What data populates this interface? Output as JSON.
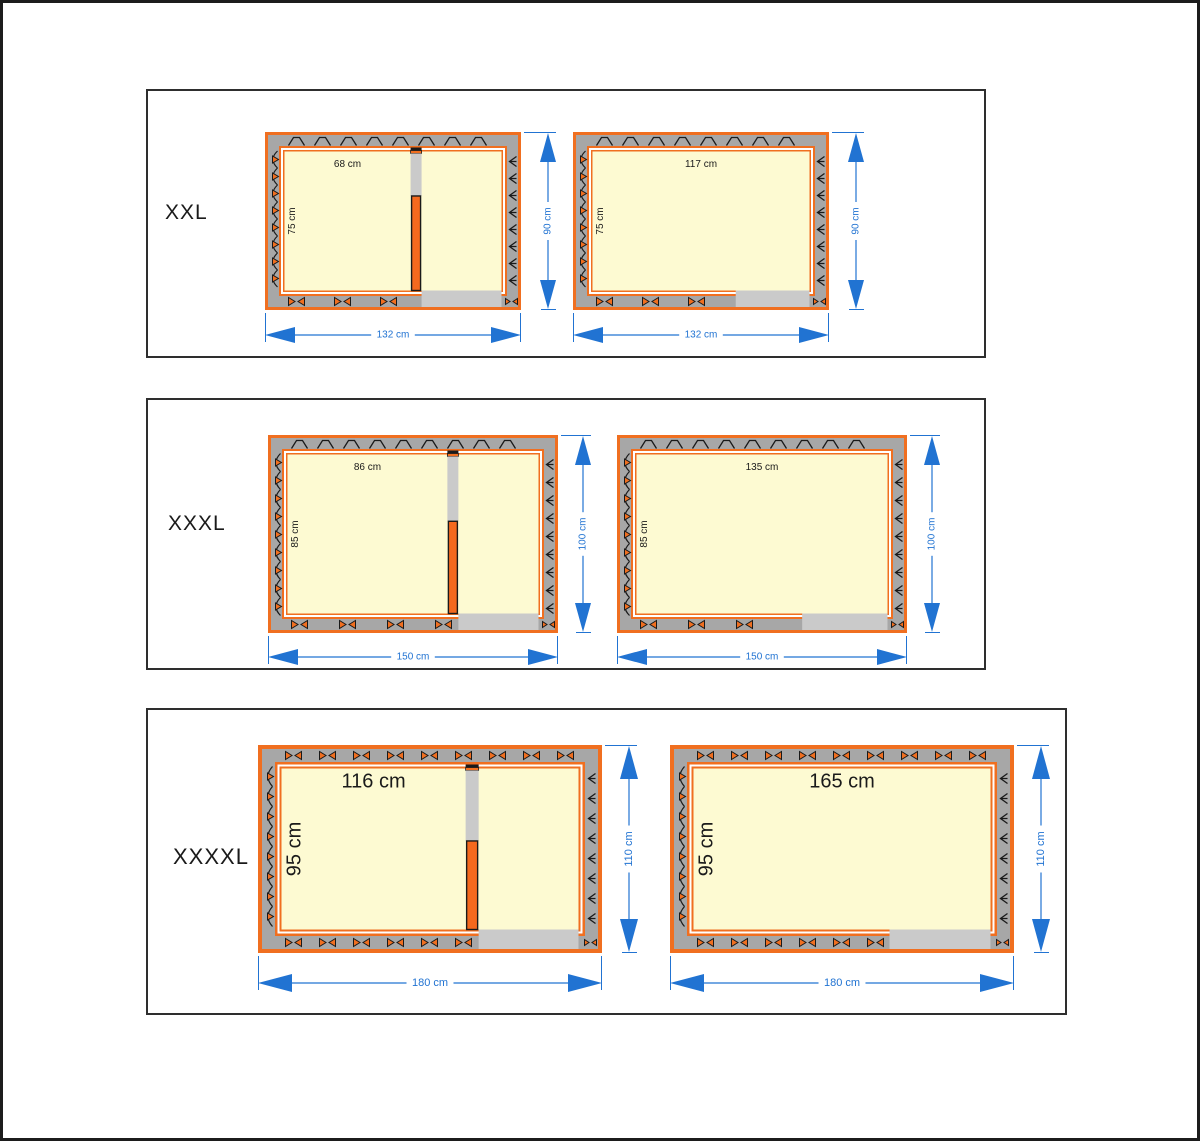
{
  "page": {
    "background": "#ffffff",
    "frame_color": "#1c1c1c",
    "panel_border_color": "#2e2e2e"
  },
  "colors": {
    "outline_orange": "#f06f20",
    "insulation_gray": "#a7a7a7",
    "interior_cream": "#fdfad2",
    "opening_gray": "#cacaca",
    "dimension_blue": "#2173d2",
    "line_black": "#1a1a1a",
    "text_black": "#1a1a1a",
    "gap_white": "#ffffff"
  },
  "rows": [
    {
      "size_label": "XXL",
      "outer_cm": {
        "w": 132,
        "h": 90
      },
      "outer_width_label": "132 cm",
      "outer_height_label": "90 cm",
      "interior_height_label": "75 cm",
      "interior_height_cm": 75,
      "diagrams": [
        {
          "variant": "with-partition",
          "interior_width_label": "68 cm",
          "interior_width_cm": 68
        },
        {
          "variant": "open",
          "interior_width_label": "117 cm",
          "interior_width_cm": 117
        }
      ]
    },
    {
      "size_label": "XXXL",
      "outer_cm": {
        "w": 150,
        "h": 100
      },
      "outer_width_label": "150 cm",
      "outer_height_label": "100 cm",
      "interior_height_label": "85 cm",
      "interior_height_cm": 85,
      "diagrams": [
        {
          "variant": "with-partition",
          "interior_width_label": "86 cm",
          "interior_width_cm": 86
        },
        {
          "variant": "open",
          "interior_width_label": "135 cm",
          "interior_width_cm": 135
        }
      ]
    },
    {
      "size_label": "XXXXL",
      "outer_cm": {
        "w": 180,
        "h": 110
      },
      "outer_width_label": "180 cm",
      "outer_height_label": "110 cm",
      "interior_height_label": "95 cm",
      "interior_height_cm": 95,
      "diagrams": [
        {
          "variant": "with-partition",
          "interior_width_label": "116 cm",
          "interior_width_cm": 116
        },
        {
          "variant": "open",
          "interior_width_label": "165 cm",
          "interior_width_cm": 165
        }
      ]
    }
  ]
}
